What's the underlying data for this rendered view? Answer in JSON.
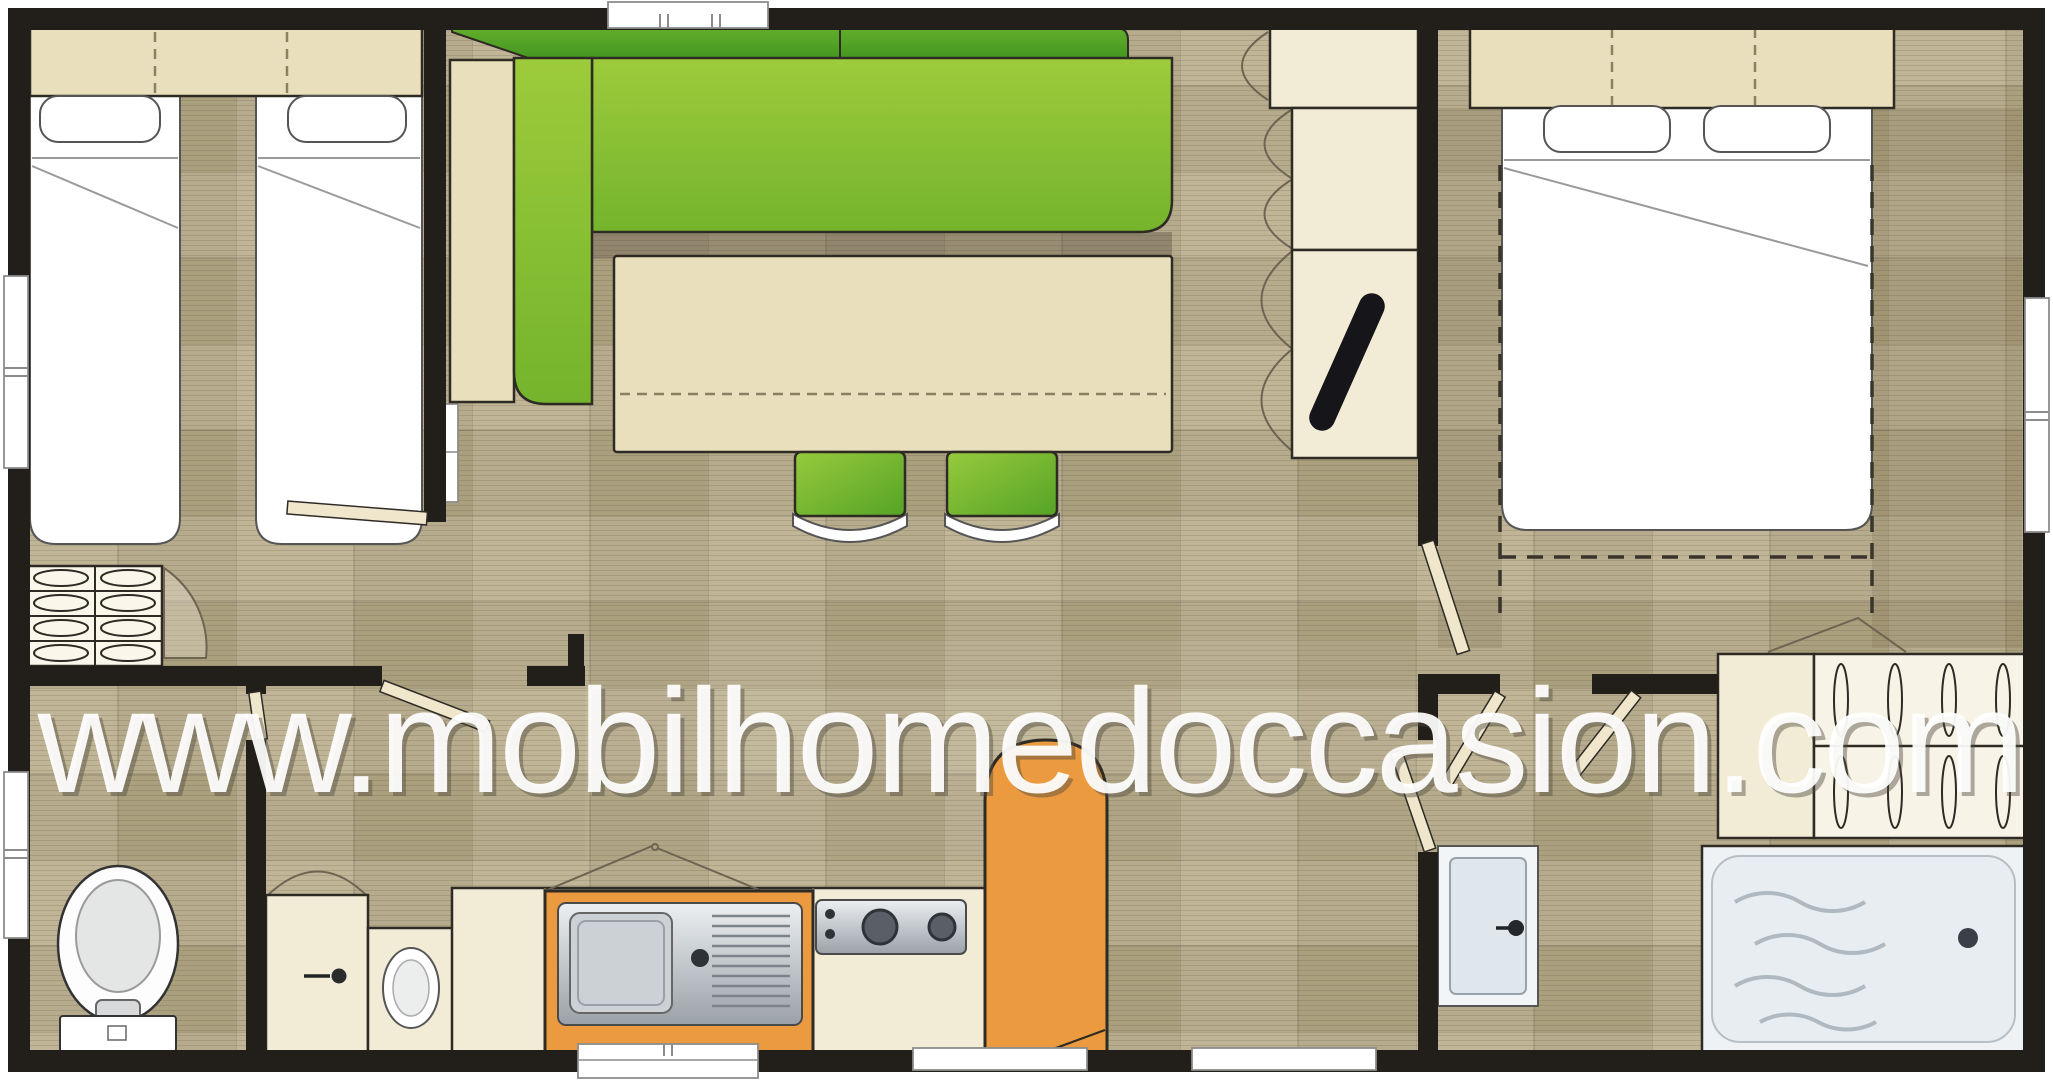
{
  "watermark": {
    "url": "www.mobilhomedoccasion.com"
  },
  "colors": {
    "wall": "#221e19",
    "floor": "#b6ab8d",
    "cream": "#f2ecd6",
    "wood": "#eadfbc",
    "sofa-green": "#8fc437",
    "sofa-green-dark": "#56a22a",
    "chair-green": "#7fc13a",
    "orange": "#eb9a3f",
    "steel-light": "#e7eaed",
    "steel-dark": "#9aa1a8",
    "shower-tray": "#eef2f5",
    "tv-black": "#15151a",
    "watermark-white": "#ffffff"
  },
  "elements": {
    "furniture": [
      "single-bed",
      "single-bed",
      "double-bed",
      "corner-sofa",
      "dining-table",
      "chair",
      "chair",
      "tv",
      "toilet",
      "washbasin",
      "kitchen-sink",
      "stove",
      "bar-counter",
      "wardrobe-folded-linen",
      "wardrobe-hangers",
      "shower-tray"
    ],
    "openings": [
      "window",
      "window",
      "window",
      "window",
      "door",
      "door",
      "door",
      "door",
      "door",
      "door",
      "door"
    ]
  }
}
